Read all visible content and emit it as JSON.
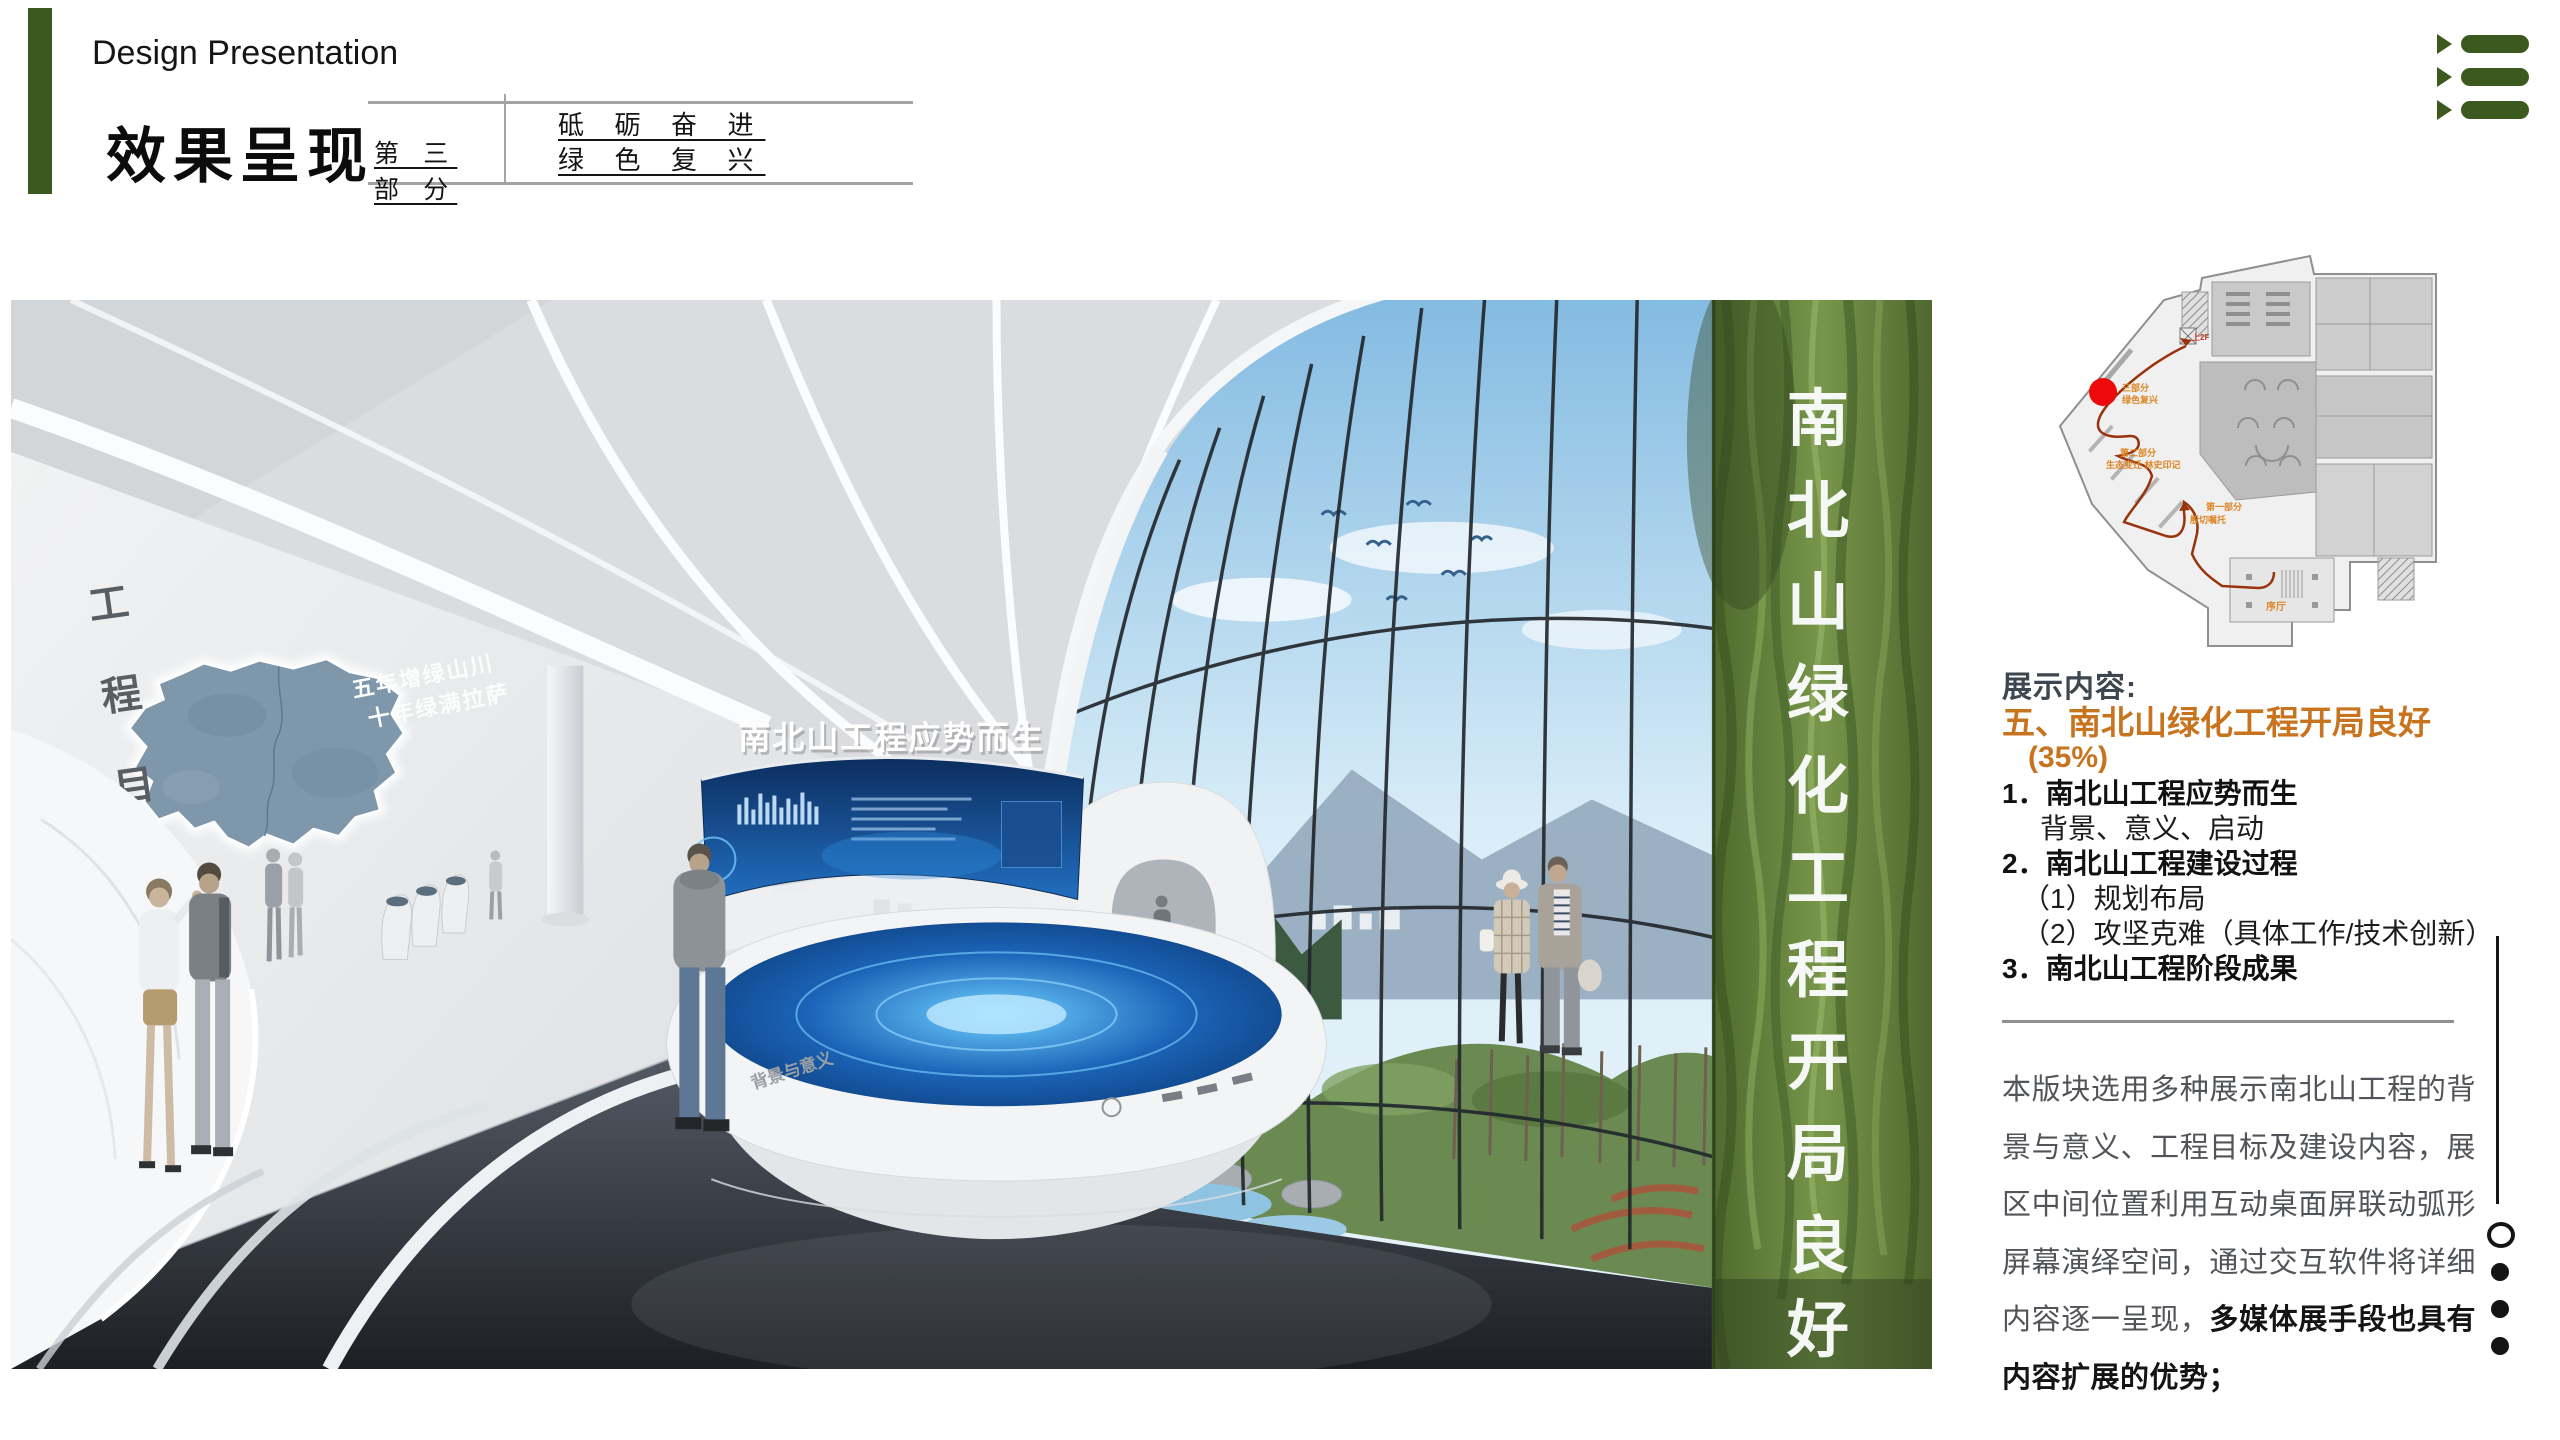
{
  "header": {
    "subtitle_en": "Design Presentation",
    "title_cn": "效果呈现",
    "part_label": "第 三 部 分",
    "slogan_line1": "砥 砺 奋 进",
    "slogan_line2": "绿 色 复 兴",
    "accent_color": "#3c5a1f"
  },
  "corner_menu": {
    "icon": "triangle-list-icon",
    "color": "#3c5a1f"
  },
  "render": {
    "wall_title_chars": [
      "工",
      "程",
      "目",
      "标"
    ],
    "wall_slogan_line1": "五年增绿山川",
    "wall_slogan_line2": "十年绿满拉萨",
    "screen_title": "南北山工程应势而生",
    "table_label": "背景与意义",
    "green_wall_chars": [
      "南",
      "北",
      "山",
      "绿",
      "化",
      "工",
      "程",
      "开",
      "局",
      "良",
      "好"
    ]
  },
  "floorplan": {
    "marker_color": "#ec0a0a",
    "route_color": "#98330d",
    "label_color": "#dd8626",
    "labels": {
      "part3_line1": "三部分",
      "part3_line2": "绿色复兴",
      "part2_line1": "第二部分",
      "part2_line2": "生态变迁 林史印记",
      "part1_line1": "第一部分",
      "part1_line2": "殷切嘱托",
      "lobby": "序厅",
      "upstairs": "上2F"
    }
  },
  "content_panel": {
    "heading": "展示内容:",
    "title": "五、南北山绿化工程开局良好",
    "percent": "(35%)",
    "orange": "#c8731e",
    "items": [
      {
        "text": "1．南北山工程应势而生"
      },
      {
        "text": "背景、意义、启动"
      },
      {
        "text": "2．南北山工程建设过程"
      },
      {
        "text": "（1）规划布局"
      },
      {
        "text": "（2）攻坚克难（具体工作/技术创新）"
      },
      {
        "text": "3．南北山工程阶段成果"
      }
    ],
    "paragraph_normal": "本版块选用多种展示南北山工程的背景与意义、工程目标及建设内容，展区中间位置利用互动桌面屏联动弧形屏幕演绎空间，通过交互软件将详细内容逐一呈现，",
    "paragraph_bold": "多媒体展手段也具有内容扩展的优势；"
  }
}
